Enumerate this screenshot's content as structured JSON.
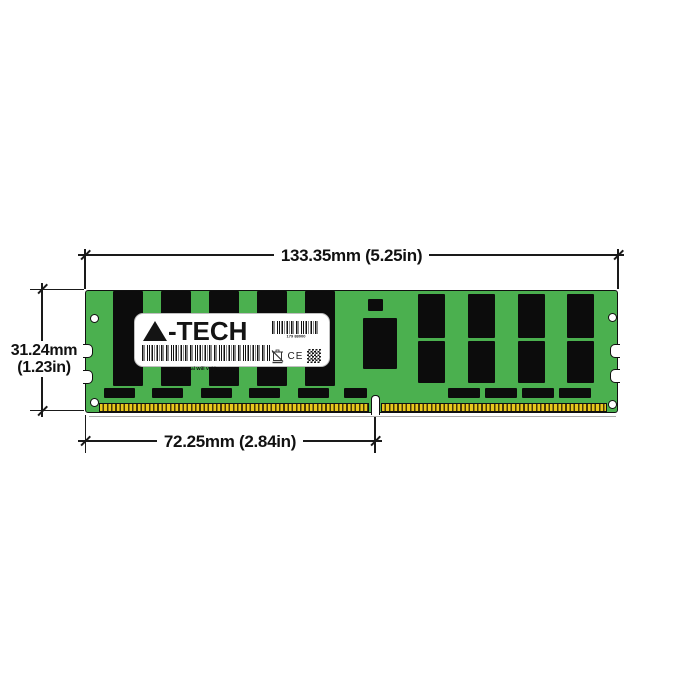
{
  "dimensions": {
    "width": "133.35mm (5.25in)",
    "height_mm": "31.24mm",
    "height_in": "(1.23in)",
    "pin_row_width": "72.25mm (2.84in)"
  },
  "label": {
    "brand_full": "A-TECH",
    "brand_text": "-TECH",
    "serial_number": "179 88000",
    "warranty_text": "Removal Will Void Warranty",
    "ce_mark": "CE"
  },
  "colors": {
    "pcb_green": "#4bb04f",
    "chip_black": "#0c0c0c",
    "pin_gold": "#e9c81d",
    "line": "#1a1a1a",
    "background": "#ffffff",
    "label_white": "#ffffff"
  }
}
